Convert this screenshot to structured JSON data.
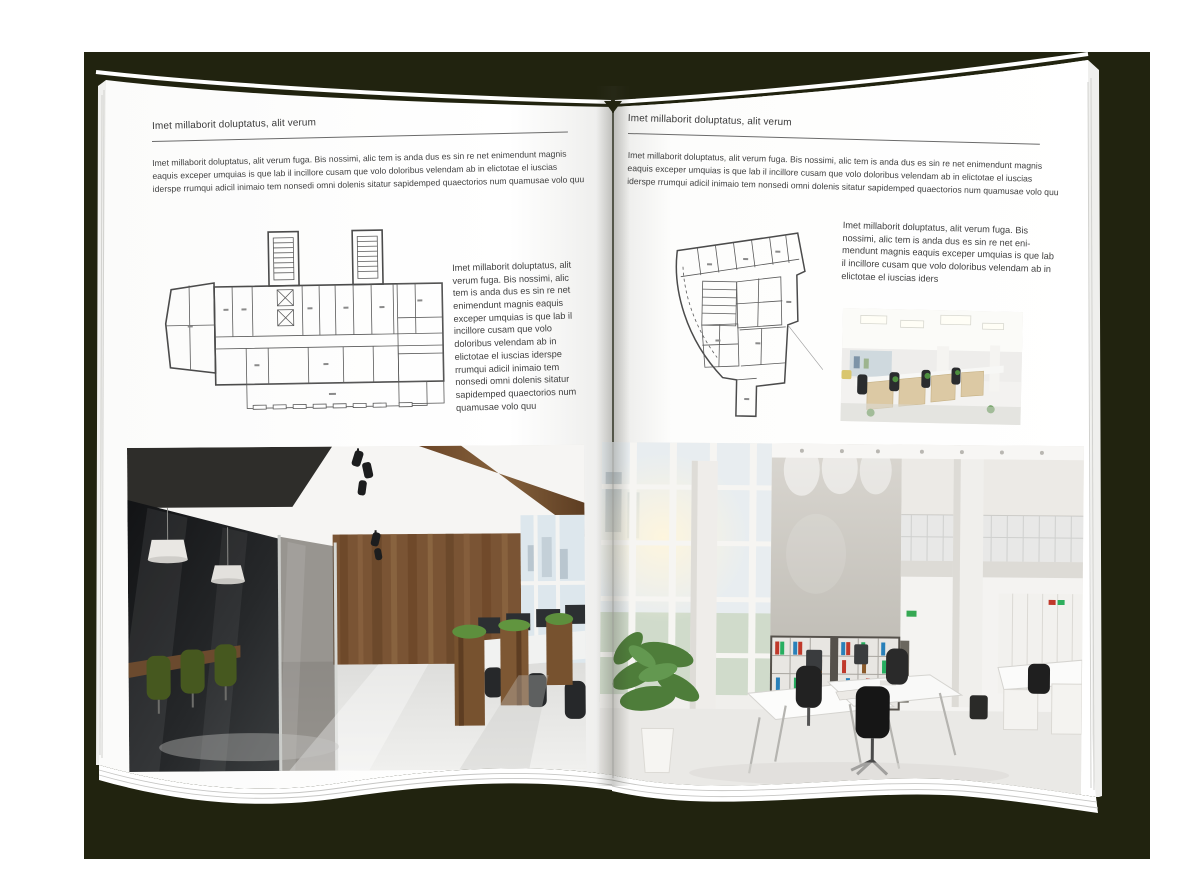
{
  "palette": {
    "backdrop_olive": "#21230f",
    "page_white": "#ffffff",
    "text_gray": "#3d3d3d",
    "wood_brown": "#7a5434",
    "chair_green": "#4a5c28",
    "plant_green": "#4e7d3a",
    "binder_red": "#c0392b",
    "binder_green": "#27ae60",
    "binder_blue": "#2980b9"
  },
  "left_page": {
    "header": "Imet millaborit doluptatus, alit verum",
    "intro": "Imet millaborit doluptatus, alit verum fuga. Bis nossimi, alic tem is anda dus es sin re net enimendunt magnis eaquis exceper umquias is que lab il incillore cusam que volo doloribus velendam ab in elictotae el iuscias iderspe rrumqui adicil inimaio tem nonsedi omni dolenis sitatur sapidemped quaectorios num quamusae volo quu",
    "aside": "Imet millaborit doluptatus, alit verum fuga. Bis nossimi, alic tem is anda dus es sin re net enimendunt magnis eaquis exceper umquias is que lab il incillore cusam que volo doloribus velendam ab in elictotae el iuscias iderspe rrumqui adicil inimaio tem nonsedi omni dolenis sitatur sapidemped quaectorios num quamusae volo quu"
  },
  "right_page": {
    "header": "Imet millaborit doluptatus, alit verum",
    "intro": "Imet millaborit doluptatus, alit verum fuga. Bis nossimi, alic tem is anda dus es sin re net enimendunt magnis eaquis exceper umquias is que lab il incillore cusam que volo doloribus velendam ab in elictotae el iuscias iderspe rrumqui adicil inimaio tem nonsedi omni dolenis sitatur sapidemped quaectorios num quamusae volo quu",
    "aside": "Imet millaborit doluptatus, alit verum fuga. Bis nossimi, alic tem is anda dus es sin re net eni-mendunt magnis eaquis exceper umquias is que lab il incillore cusam que volo doloribus velendam ab in elictotae el iuscias iders"
  }
}
